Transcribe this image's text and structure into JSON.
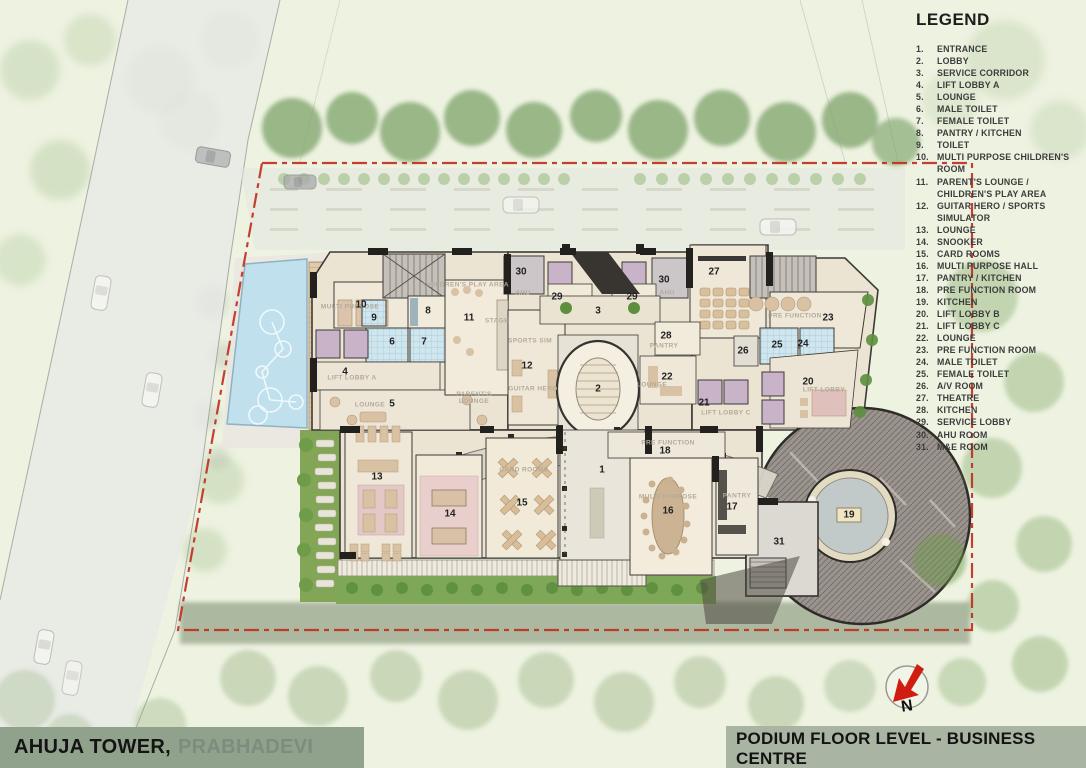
{
  "colors": {
    "boundary_red": "#c03020",
    "bar_left_bg": "#90a28c",
    "bar_right_bg": "#a9b5a2",
    "pool_blue": "#bfe0ec",
    "roof_gray": "#9b948e"
  },
  "legend": {
    "title": "LEGEND",
    "items": [
      {
        "no": "1.",
        "label": "ENTRANCE"
      },
      {
        "no": "2.",
        "label": "LOBBY"
      },
      {
        "no": "3.",
        "label": "SERVICE CORRIDOR"
      },
      {
        "no": "4.",
        "label": "LIFT LOBBY A"
      },
      {
        "no": "5.",
        "label": "LOUNGE"
      },
      {
        "no": "6.",
        "label": "MALE TOILET"
      },
      {
        "no": "7.",
        "label": "FEMALE TOILET"
      },
      {
        "no": "8.",
        "label": "PANTRY / KITCHEN"
      },
      {
        "no": "9.",
        "label": "TOILET"
      },
      {
        "no": "10.",
        "label": "MULTI PURPOSE CHILDREN'S ROOM"
      },
      {
        "no": "11.",
        "label": "PARENT'S LOUNGE / CHILDREN'S PLAY AREA"
      },
      {
        "no": "12.",
        "label": "GUITAR HERO / SPORTS SIMULATOR"
      },
      {
        "no": "13.",
        "label": "LOUNGE"
      },
      {
        "no": "14.",
        "label": "SNOOKER"
      },
      {
        "no": "15.",
        "label": "CARD ROOMS"
      },
      {
        "no": "16.",
        "label": "MULTI PURPOSE HALL"
      },
      {
        "no": "17.",
        "label": "PANTRY / KITCHEN"
      },
      {
        "no": "18.",
        "label": "PRE FUNCTION ROOM"
      },
      {
        "no": "19.",
        "label": "KITCHEN"
      },
      {
        "no": "20.",
        "label": "LIFT LOBBY B"
      },
      {
        "no": "21.",
        "label": "LIFT LOBBY C"
      },
      {
        "no": "22.",
        "label": "LOUNGE"
      },
      {
        "no": "23.",
        "label": "PRE FUNCTION ROOM"
      },
      {
        "no": "24.",
        "label": "MALE TOILET"
      },
      {
        "no": "25.",
        "label": "FEMALE TOILET"
      },
      {
        "no": "26.",
        "label": "A/V ROOM"
      },
      {
        "no": "27.",
        "label": "THEATRE"
      },
      {
        "no": "28.",
        "label": "KITCHEN"
      },
      {
        "no": "29.",
        "label": "SERVICE LOBBY"
      },
      {
        "no": "30.",
        "label": "AHU ROOM"
      },
      {
        "no": "31.",
        "label": "M&E ROOM"
      }
    ]
  },
  "footer": {
    "project_name": "AHUJA TOWER,",
    "project_location": "PRABHADEVI",
    "drawing_title": "PODIUM FLOOR LEVEL - BUSINESS CENTRE"
  },
  "scale_bar": {
    "t0": "0",
    "t5": "5",
    "t10": "10m"
  },
  "north_label": "N",
  "room_markers": [
    {
      "no": "1",
      "x": 602,
      "y": 470
    },
    {
      "no": "2",
      "x": 598,
      "y": 389
    },
    {
      "no": "3",
      "x": 598,
      "y": 311
    },
    {
      "no": "4",
      "x": 345,
      "y": 372
    },
    {
      "no": "5",
      "x": 392,
      "y": 404
    },
    {
      "no": "6",
      "x": 392,
      "y": 342
    },
    {
      "no": "7",
      "x": 424,
      "y": 342
    },
    {
      "no": "8",
      "x": 428,
      "y": 311
    },
    {
      "no": "9",
      "x": 374,
      "y": 318
    },
    {
      "no": "10",
      "x": 361,
      "y": 305
    },
    {
      "no": "11",
      "x": 469,
      "y": 318
    },
    {
      "no": "12",
      "x": 527,
      "y": 366
    },
    {
      "no": "13",
      "x": 377,
      "y": 477
    },
    {
      "no": "14",
      "x": 450,
      "y": 514
    },
    {
      "no": "15",
      "x": 522,
      "y": 503
    },
    {
      "no": "16",
      "x": 668,
      "y": 511
    },
    {
      "no": "17",
      "x": 732,
      "y": 507
    },
    {
      "no": "18",
      "x": 665,
      "y": 451
    },
    {
      "no": "19",
      "x": 849,
      "y": 515,
      "boxed": true
    },
    {
      "no": "20",
      "x": 808,
      "y": 382
    },
    {
      "no": "21",
      "x": 704,
      "y": 403
    },
    {
      "no": "22",
      "x": 667,
      "y": 377
    },
    {
      "no": "23",
      "x": 828,
      "y": 318
    },
    {
      "no": "24",
      "x": 803,
      "y": 344
    },
    {
      "no": "25",
      "x": 777,
      "y": 345
    },
    {
      "no": "26",
      "x": 743,
      "y": 351
    },
    {
      "no": "27",
      "x": 714,
      "y": 272
    },
    {
      "no": "28",
      "x": 666,
      "y": 336
    },
    {
      "no": "29",
      "x": 557,
      "y": 297
    },
    {
      "no": "29",
      "x": 632,
      "y": 297
    },
    {
      "no": "30",
      "x": 521,
      "y": 272
    },
    {
      "no": "30",
      "x": 664,
      "y": 280
    },
    {
      "no": "31",
      "x": 779,
      "y": 542
    }
  ],
  "plan_labels": [
    {
      "text": "AHU",
      "x": 523,
      "y": 293
    },
    {
      "text": "AHU",
      "x": 667,
      "y": 293
    },
    {
      "text": "SPORTS SIM",
      "x": 530,
      "y": 341
    },
    {
      "text": "GUITAR HERO",
      "x": 533,
      "y": 389
    },
    {
      "text": "STAGE",
      "x": 497,
      "y": 321
    },
    {
      "text": "LIFT LOBBY A",
      "x": 352,
      "y": 378
    },
    {
      "text": "LOUNGE",
      "x": 370,
      "y": 405
    },
    {
      "text": "LOUNGE",
      "x": 652,
      "y": 385
    },
    {
      "text": "PRE FUNCTION",
      "x": 795,
      "y": 316
    },
    {
      "text": "PRE FUNCTION",
      "x": 668,
      "y": 443
    },
    {
      "text": "PANTRY",
      "x": 737,
      "y": 496
    },
    {
      "text": "PANTRY",
      "x": 664,
      "y": 346
    },
    {
      "text": "MULTI PURPOSE",
      "x": 350,
      "y": 307
    },
    {
      "text": "MULTI PURPOSE",
      "x": 668,
      "y": 497
    },
    {
      "text": "LIFT LOBBY C",
      "x": 726,
      "y": 413
    },
    {
      "text": "LIFT LOBBY",
      "x": 824,
      "y": 390
    },
    {
      "text": "CARD ROOMS",
      "x": 524,
      "y": 470
    },
    {
      "text": "CHILDREN'S PLAY AREA",
      "x": 466,
      "y": 285
    },
    {
      "text": "PARENT'S LOUNGE",
      "x": 474,
      "y": 398,
      "wrap": true
    }
  ]
}
